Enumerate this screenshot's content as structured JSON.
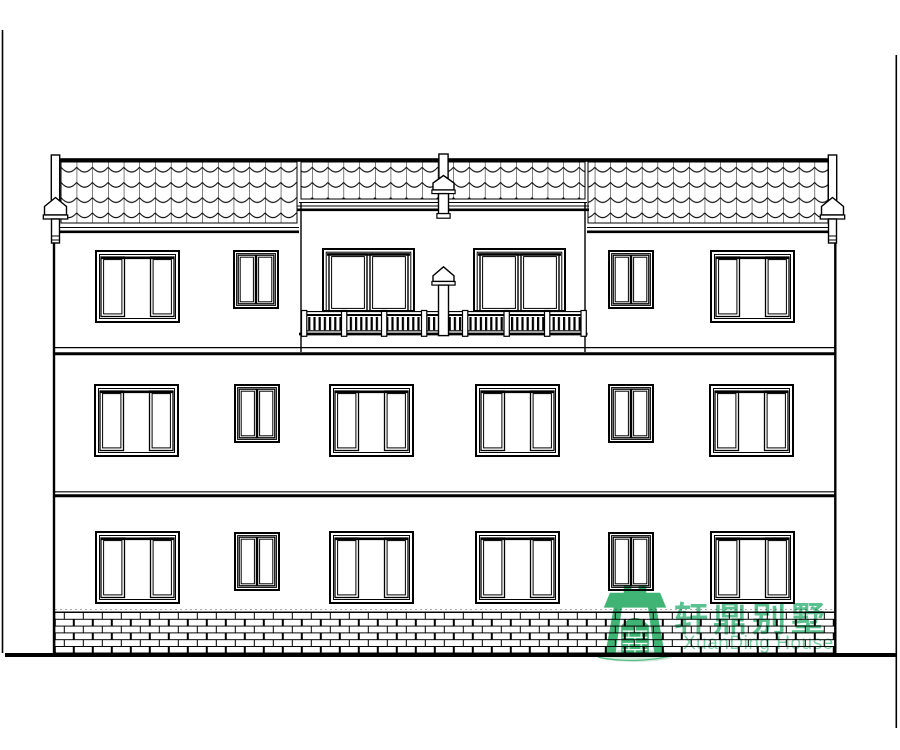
{
  "page": {
    "background_color": "#ffffff",
    "ink_color": "#000000"
  },
  "watermark": {
    "brand_name_cn": "轩鼎别墅",
    "brand_name_en": "XuanDing House",
    "cn_text_color": "#36b377",
    "en_text_color": "#63c796",
    "emblem_color": "#2fae68",
    "emblem_shadow_color": "#cfe9d8",
    "emblem_icon": "green-arch-gate-logo"
  }
}
